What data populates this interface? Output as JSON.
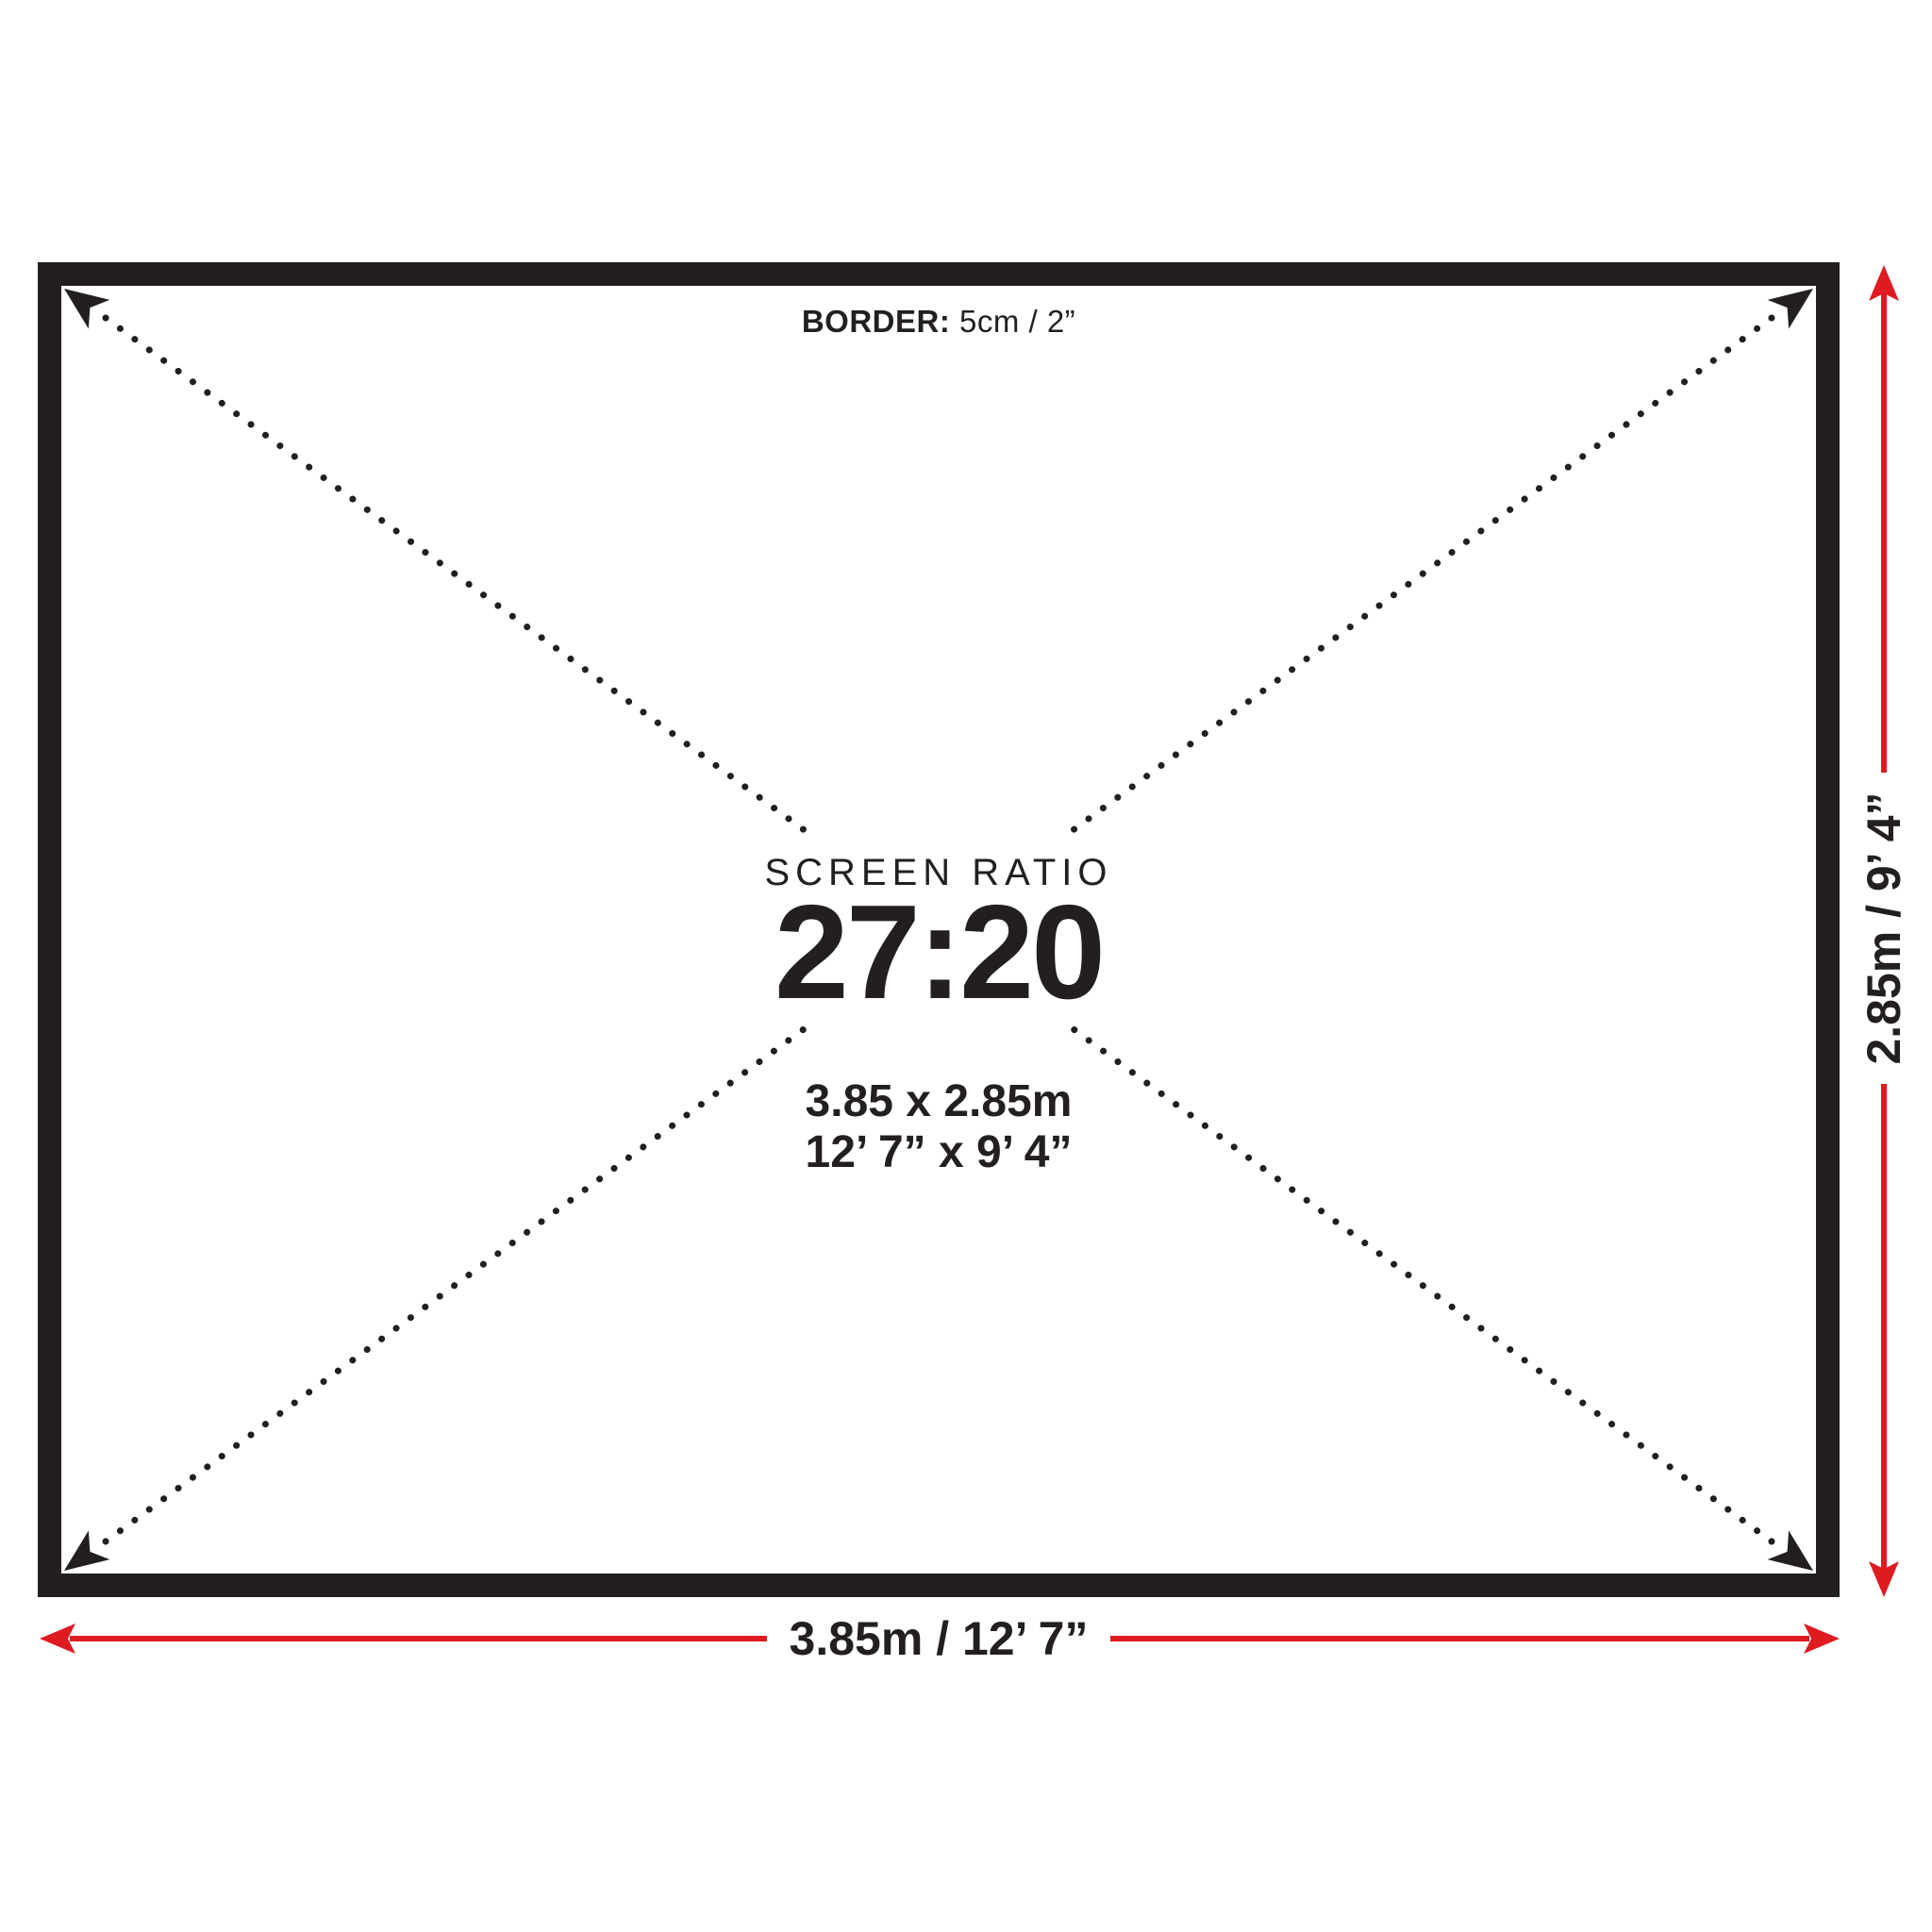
{
  "diagram": {
    "title_context": "screen-size-spec-diagram",
    "border_note": {
      "bold": "BORDER:",
      "rest": " 5cm / 2”"
    },
    "center": {
      "ratio_label": "SCREEN RATIO",
      "ratio_value": "27:20",
      "size_metric": "3.85 x 2.85m",
      "size_imperial": "12’ 7” x 9’ 4”"
    },
    "width_dimension": "3.85m / 12’ 7”",
    "height_dimension": "2.85m / 9’ 4”",
    "colors": {
      "ink": "#231f20",
      "accent_red": "#dd1b21",
      "background": "#ffffff"
    }
  }
}
